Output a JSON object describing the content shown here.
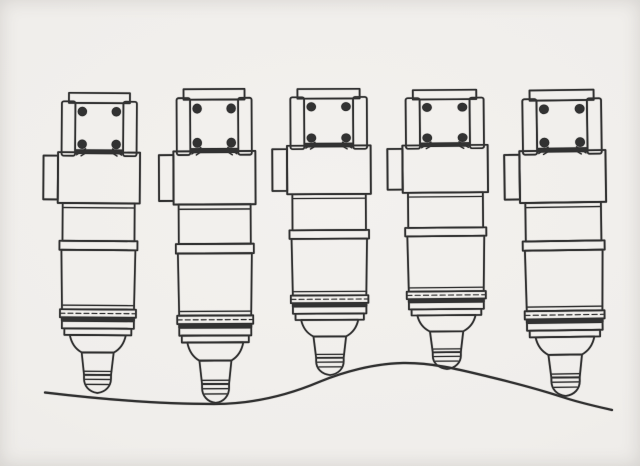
{
  "figure": {
    "title": "Five fuel injectors on an uneven surface",
    "type": "technical-line-drawing",
    "description": "Scanned pen-and-ink style engineering illustration of five identical diesel fuel injectors standing side by side, nozzle tips resting on a wavy ground line.",
    "injector_count": 5,
    "visible_text": ""
  },
  "colors": {
    "ink": "#2b2b2b",
    "paper": "#f0eeeb",
    "paper_edge": "#e4e2df"
  },
  "parts": [
    {
      "name": "cap-plate"
    },
    {
      "name": "left-clamp-rail"
    },
    {
      "name": "right-clamp-rail"
    },
    {
      "name": "clamp-frame"
    },
    {
      "name": "clamp-bolts"
    },
    {
      "name": "bolt-ticks"
    },
    {
      "name": "seal-bar"
    },
    {
      "name": "mounting-collar"
    },
    {
      "name": "collar-tab"
    },
    {
      "name": "upper-barrel"
    },
    {
      "name": "locating-ring"
    },
    {
      "name": "body-cylinder"
    },
    {
      "name": "compression-bands"
    },
    {
      "name": "dark-band"
    },
    {
      "name": "nozzle-cone"
    },
    {
      "name": "nozzle-stem"
    },
    {
      "name": "nozzle-tip"
    }
  ],
  "injectors": [
    {
      "id": "injector-1",
      "transform": "translate(99.5,92) rotate(0.4) scale(1,1.0067)"
    },
    {
      "id": "injector-2",
      "transform": "translate(214,88) rotate(-0.3) scale(1,1.0533)"
    },
    {
      "id": "injector-3",
      "transform": "translate(328.5,88) rotate(-0.3) scale(1.02,0.96)"
    },
    {
      "id": "injector-4",
      "transform": "translate(444.5,89) rotate(-0.5) scale(1.04,0.9367)"
    },
    {
      "id": "injector-5",
      "transform": "translate(561.5,89) rotate(-0.8) scale(1.05,1.0267)"
    }
  ],
  "ground": {
    "path": "M45,392.5 C95,398.5 158,404 214,404 C252,404 287,395.5 319,382 C343,372 374,363.5 403,363 C434,362.5 463,370.5 492,377.5 C521,384.5 546,391.5 567,398.5 C583,403.5 599,407 612,410"
  }
}
